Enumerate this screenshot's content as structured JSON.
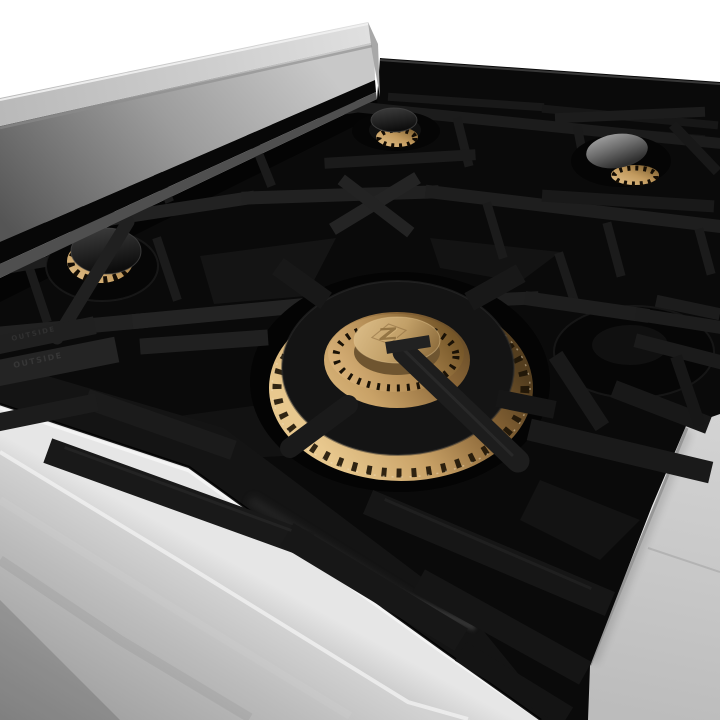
{
  "meta": {
    "type": "product-photograph",
    "subject": "Close-up of a gas rangetop: black porcelain cooktop, matte cast-iron grates, polished brass burners, stainless steel body",
    "background": "white-to-gray studio backdrop"
  },
  "brand": {
    "logo_glyph": "Z",
    "logo_location": "embossed on center burner brass cap"
  },
  "embossed": {
    "grate_marking_top": "OUTSIDE",
    "grate_marking_bottom": "OUTSIDE"
  },
  "colors": {
    "white_bg": "#ffffff",
    "backdrop_gray": "#cbcbcb",
    "stainless_light": "#d9d9d9",
    "stainless_mid": "#ababab",
    "stainless_dark": "#878787",
    "porcelain_black": "#0a0a0a",
    "grate_iron": "#1f1f1f",
    "brass_bright": "#e2bf86",
    "brass_mid": "#b08c54",
    "brass_dark": "#6e5329",
    "cap_brass": "#c9a76e"
  },
  "burners": [
    {
      "id": "left-front",
      "cap": "black",
      "ring": "brass"
    },
    {
      "id": "back-center",
      "cap": "black",
      "ring": "brass"
    },
    {
      "id": "back-right",
      "cap": "gray highlight",
      "ring": "brass"
    },
    {
      "id": "center",
      "cap": "brass with embossed Z logo",
      "ring": "brass"
    },
    {
      "id": "right-center",
      "cap": "black (in shadow)",
      "ring": "hidden"
    }
  ]
}
